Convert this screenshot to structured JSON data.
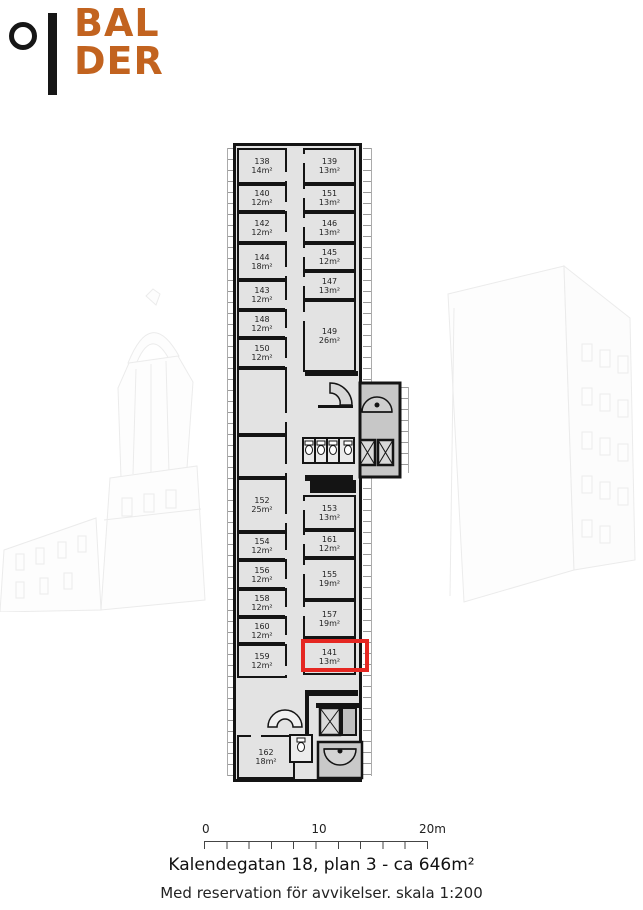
{
  "logo": {
    "line1": "BAL",
    "line2": "DER",
    "orange": "#c2631f"
  },
  "colors": {
    "highlight_red": "#e52722",
    "wall_black": "#141414",
    "floor_gray": "#e3e3e3"
  },
  "plan": {
    "highlighted_room": "141",
    "rooms": [
      {
        "n": "138",
        "a": "14m²",
        "x": 9,
        "y": 8,
        "w": 50,
        "h": 36,
        "door": "r"
      },
      {
        "n": "139",
        "a": "13m²",
        "x": 75,
        "y": 8,
        "w": 53,
        "h": 36,
        "door": "l"
      },
      {
        "n": "140",
        "a": "12m²",
        "x": 9,
        "y": 44,
        "w": 50,
        "h": 28,
        "door": "r"
      },
      {
        "n": "151",
        "a": "13m²",
        "x": 75,
        "y": 44,
        "w": 53,
        "h": 28,
        "door": "l"
      },
      {
        "n": "142",
        "a": "12m²",
        "x": 9,
        "y": 72,
        "w": 50,
        "h": 31,
        "door": "r"
      },
      {
        "n": "146",
        "a": "13m²",
        "x": 75,
        "y": 72,
        "w": 53,
        "h": 31,
        "door": "l"
      },
      {
        "n": "144",
        "a": "18m²",
        "x": 9,
        "y": 103,
        "w": 50,
        "h": 37,
        "door": "r"
      },
      {
        "n": "145",
        "a": "12m²",
        "x": 75,
        "y": 103,
        "w": 53,
        "h": 28,
        "door": "l"
      },
      {
        "n": "143",
        "a": "12m²",
        "x": 9,
        "y": 140,
        "w": 50,
        "h": 30,
        "door": "r"
      },
      {
        "n": "147",
        "a": "13m²",
        "x": 75,
        "y": 131,
        "w": 53,
        "h": 29,
        "door": "l"
      },
      {
        "n": "148",
        "a": "12m²",
        "x": 9,
        "y": 170,
        "w": 50,
        "h": 28,
        "door": "r"
      },
      {
        "n": "149",
        "a": "26m²",
        "x": 75,
        "y": 160,
        "w": 53,
        "h": 72,
        "door": "l"
      },
      {
        "n": "150",
        "a": "12m²",
        "x": 9,
        "y": 198,
        "w": 50,
        "h": 30,
        "door": "r"
      },
      {
        "n": "",
        "a": "",
        "x": 9,
        "y": 228,
        "w": 50,
        "h": 67,
        "door": "r"
      },
      {
        "n": "",
        "a": "",
        "x": 9,
        "y": 295,
        "w": 50,
        "h": 43,
        "door": "r"
      },
      {
        "n": "152",
        "a": "25m²",
        "x": 9,
        "y": 338,
        "w": 50,
        "h": 54,
        "door": "r"
      },
      {
        "n": "153",
        "a": "13m²",
        "x": 75,
        "y": 355,
        "w": 53,
        "h": 35,
        "door": "l"
      },
      {
        "n": "154",
        "a": "12m²",
        "x": 9,
        "y": 392,
        "w": 50,
        "h": 28,
        "door": "r"
      },
      {
        "n": "161",
        "a": "12m²",
        "x": 75,
        "y": 390,
        "w": 53,
        "h": 28,
        "door": "l"
      },
      {
        "n": "156",
        "a": "12m²",
        "x": 9,
        "y": 420,
        "w": 50,
        "h": 29,
        "door": "r"
      },
      {
        "n": "155",
        "a": "19m²",
        "x": 75,
        "y": 418,
        "w": 53,
        "h": 42,
        "door": "l"
      },
      {
        "n": "158",
        "a": "12m²",
        "x": 9,
        "y": 449,
        "w": 50,
        "h": 28,
        "door": "r"
      },
      {
        "n": "157",
        "a": "19m²",
        "x": 75,
        "y": 460,
        "w": 53,
        "h": 38,
        "door": "l"
      },
      {
        "n": "160",
        "a": "12m²",
        "x": 9,
        "y": 477,
        "w": 50,
        "h": 27,
        "door": "r"
      },
      {
        "n": "159",
        "a": "12m²",
        "x": 9,
        "y": 504,
        "w": 50,
        "h": 34,
        "door": "r"
      },
      {
        "n": "141",
        "a": "13m²",
        "x": 75,
        "y": 498,
        "w": 53,
        "h": 37,
        "door": "l"
      },
      {
        "n": "162",
        "a": "18m²",
        "x": 9,
        "y": 595,
        "w": 58,
        "h": 44,
        "door": "t"
      }
    ]
  },
  "scalebar": {
    "labels": [
      "0",
      "10",
      "20m"
    ]
  },
  "caption": {
    "title": "Kalendegatan 18, plan 3 - ca 646m²",
    "disclaimer": "Med reservation för avvikelser. skala 1:200"
  }
}
